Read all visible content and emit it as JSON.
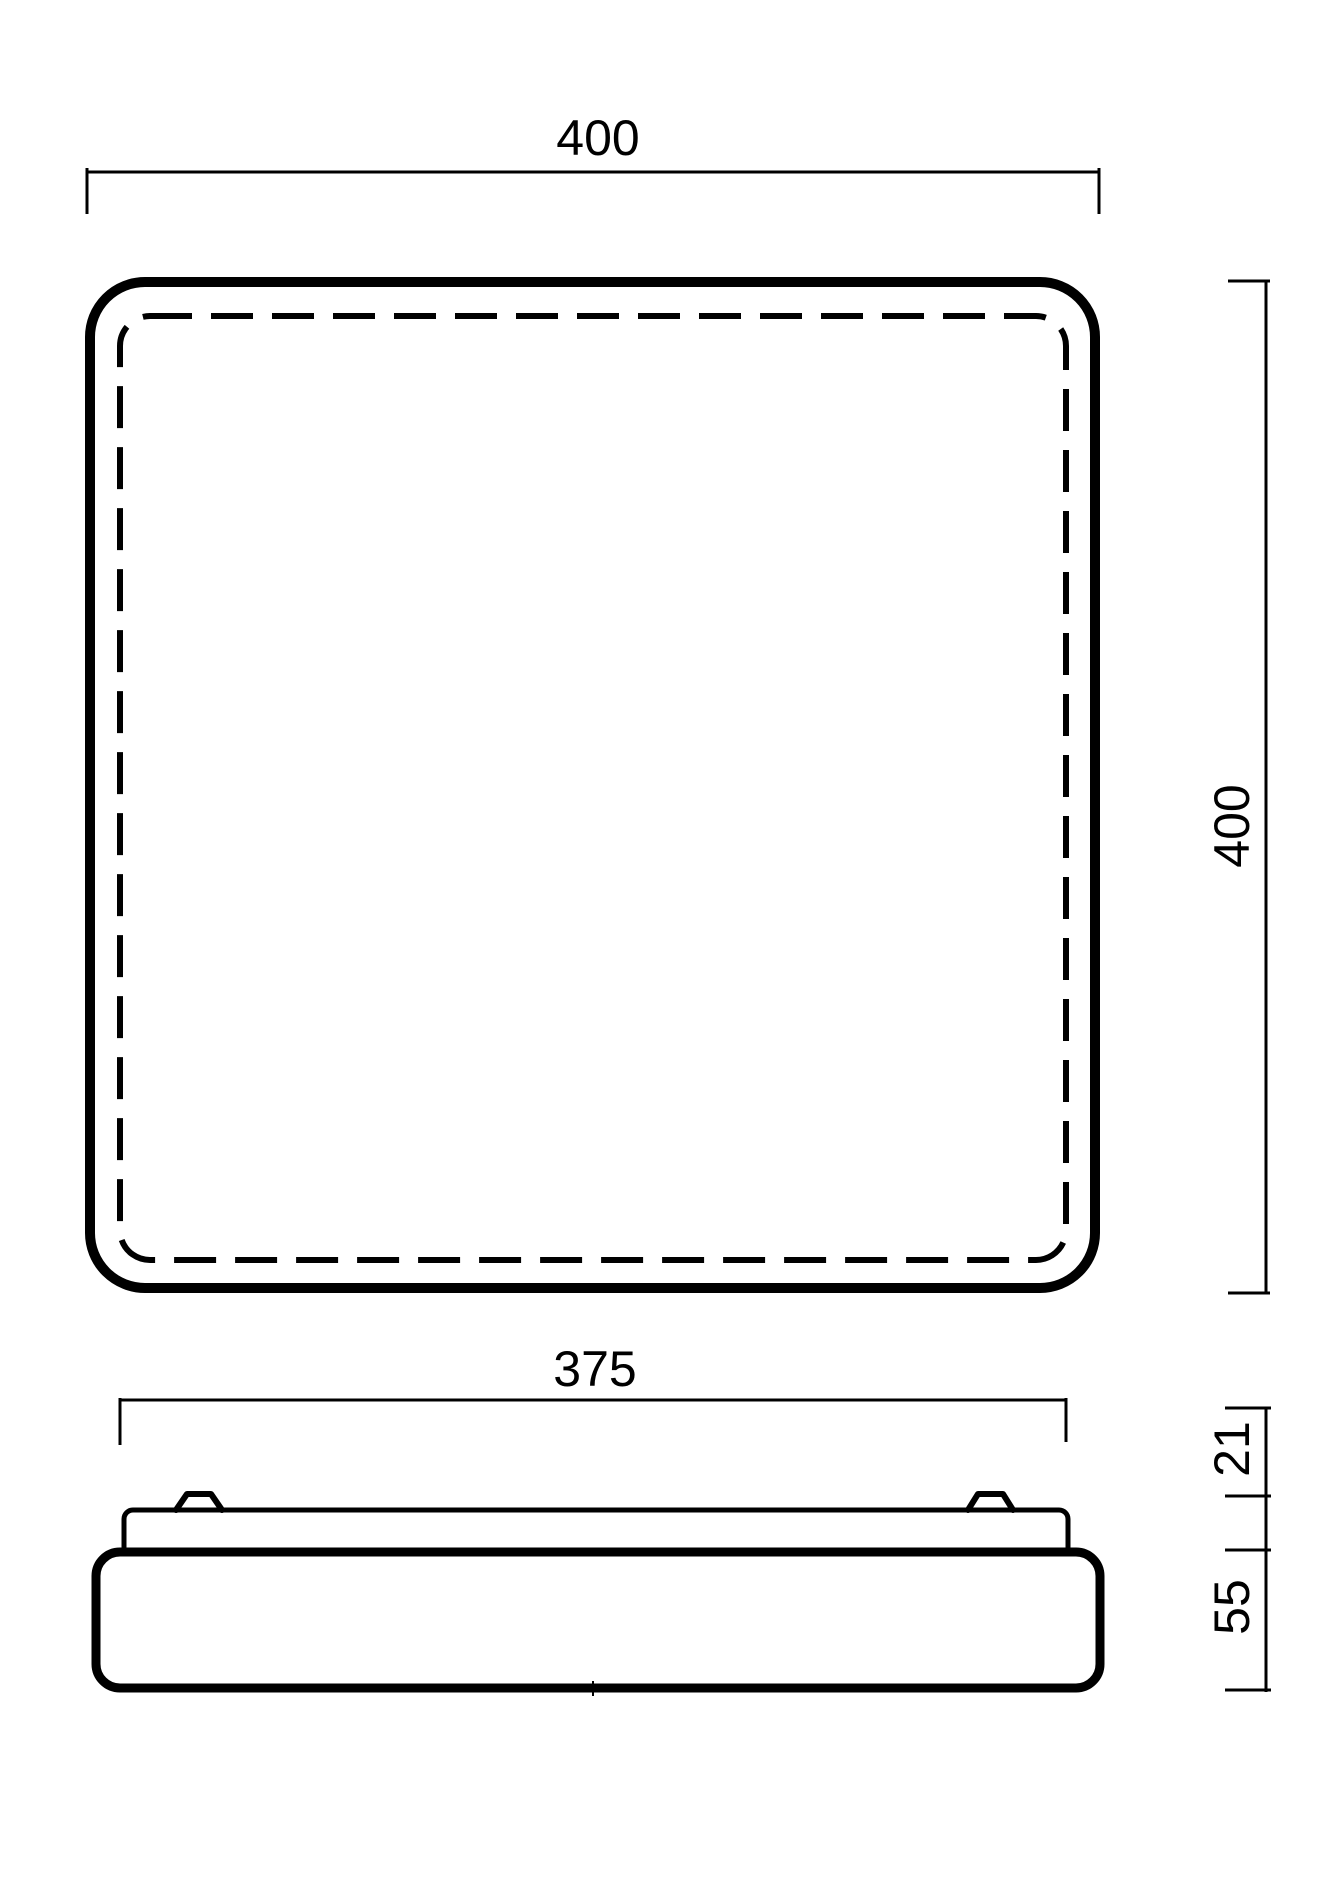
{
  "colors": {
    "line": "#000000",
    "background": "#ffffff"
  },
  "top_view": {
    "width_dim_label": "400",
    "height_dim_label": "400"
  },
  "side_view": {
    "width_dim_label": "375",
    "mount_height_dim_label": "21",
    "body_height_dim_label": "55"
  }
}
